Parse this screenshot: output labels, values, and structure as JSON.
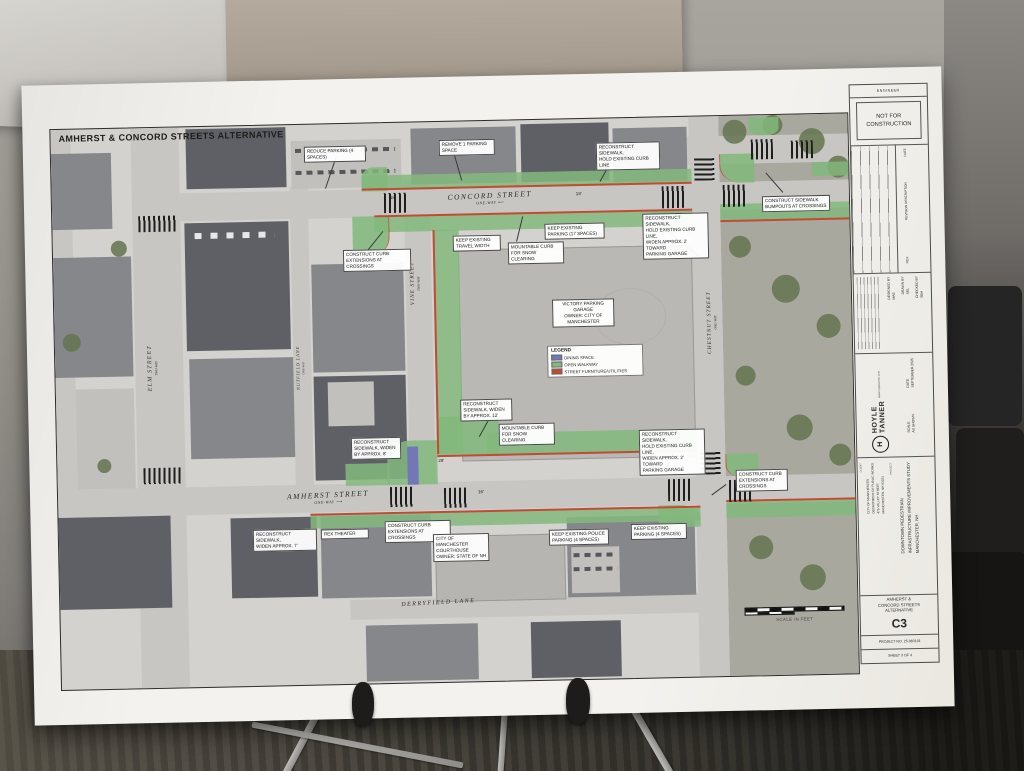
{
  "plan": {
    "title": "AMHERST & CONCORD STREETS ALTERNATIVE",
    "streets": {
      "concord": "CONCORD STREET",
      "concord_dir": "ONE-WAY  ⟵",
      "amherst": "AMHERST STREET",
      "amherst_dir": "ONE-WAY  ⟶",
      "vine": "VINE STREET",
      "vine_dir": "TWO-WAY",
      "chestnut": "CHESTNUT STREET",
      "chestnut_dir": "ONE-WAY",
      "elm": "ELM STREET",
      "elm_dir": "TWO-WAY",
      "nutfield": "NUTFIELD LANE",
      "nutfield_dir": "ONE-WAY",
      "derryfield": "DERRYFIELD LANE"
    },
    "callouts": [
      "REDUCE PARKING (4\nSPACES)",
      "REMOVE 1 PARKING\nSPACE",
      "RECONSTRUCT SIDEWALK,\nHOLD EXISTING CURB\nLINE",
      "CONSTRUCT SIDEWALK\nBUMPOUTS AT CROSSINGS",
      "CONSTRUCT CURB\nEXTENSIONS AT CROSSINGS",
      "KEEP EXISTING\nTRAVEL WIDTH",
      "MOUNTABLE CURB\nFOR SNOW CLEARING",
      "KEEP EXISTING\nPARKING (17 SPACES)",
      "RECONSTRUCT SIDEWALK,\nHOLD EXISTING CURB LINE,\nWIDEN APPROX. 2' TOWARD\nPARKING GARAGE",
      "RECONSTRUCT\nSIDEWALK, WIDEN\nBY APPROX. 12'",
      "MOUNTABLE CURB\nFOR SNOW CLEARING",
      "RECONSTRUCT\nSIDEWALK, WIDEN\nBY APPROX. 8'",
      "RECONSTRUCT SIDEWALK,\nHOLD EXISTING CURB LINE,\nWIDEN APPROX. 2' TOWARD\nPARKING GARAGE",
      "CONSTRUCT CURB\nEXTENSIONS AT\nCROSSINGS",
      "RECONSTRUCT SIDEWALK,\nWIDEN APPROX. 7'",
      "REX THEATER",
      "CONSTRUCT CURB\nEXTENSIONS AT CROSSINGS",
      "CITY OF MANCHESTER\nCOURTHOUSE\nOWNER: STATE OF NH",
      "KEEP EXISTING POLICE\nPARKING (4 SPACES)",
      "KEEP EXISTING\nPARKING (4 SPACES)",
      "VICTORY PARKING\nGARAGE\nOWNER: CITY OF\nMANCHESTER"
    ],
    "dims": [
      "18'",
      "18'",
      "28'",
      "16'"
    ],
    "legend": {
      "title": "LEGEND",
      "items": [
        {
          "label": "DINING SPACE",
          "color": "#7277b8"
        },
        {
          "label": "OPEN WALKWAY",
          "color": "#82b97c"
        },
        {
          "label": "STREET FURNITURE/UTILITIES",
          "color": "#c44a38"
        }
      ]
    },
    "scale_label": "SCALE IN FEET",
    "tb": {
      "engineer": "ENGINEER",
      "stamp": "NOT FOR\nCONSTRUCTION",
      "rev_date": "DATE",
      "rev_desc": "REVISION DESCRIPTION",
      "rev": "REV.",
      "designed": "DESIGNED BY\nMAE",
      "drawn": "DRAWN BY\nSEL",
      "checked": "CHECKED BY\nSBH",
      "firm_name": "HOYLE\nTANNER",
      "firm_url": "www.hoyletanner.com",
      "firm_logo_glyph": "H",
      "date": "DATE\nSEPTEMBER 2025",
      "scale": "SCALE\nAS SHOWN",
      "client_label": "CLIENT",
      "client": "CITY OF MANCHESTER\nDEPARTMENT OF PUBLIC WORKS\n475 VALLEY STREET\nMANCHESTER, NH 03103",
      "project_label": "PROJECT",
      "project": "DOWNTOWN PEDESTRIAN\nINFRASTRUCTURE IMPROVEMENTS STUDY\nMANCHESTER, NH",
      "sheet_title": "AMHERST &\nCONCORD STREETS\nALTERNATIVE",
      "sheet_no": "C3",
      "project_no": "PROJECT NO. 25.083101",
      "sheet_count": "SHEET  3  OF  4"
    }
  }
}
